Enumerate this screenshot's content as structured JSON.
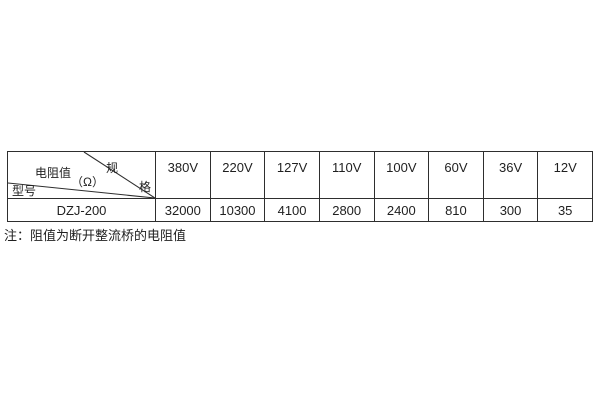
{
  "table": {
    "corner": {
      "spec_top": "规",
      "spec_bottom": "格",
      "resistance_label": "电阻值",
      "resistance_unit": "（Ω）",
      "model_label": "型号"
    },
    "voltage_headers": [
      "380V",
      "220V",
      "127V",
      "110V",
      "100V",
      "60V",
      "36V",
      "12V"
    ],
    "rows": [
      {
        "model": "DZJ-200",
        "values": [
          "32000",
          "10300",
          "4100",
          "2800",
          "2400",
          "810",
          "300",
          "35"
        ]
      }
    ]
  },
  "note": "注：阻值为断开整流桥的电阻值",
  "colors": {
    "background": "#ffffff",
    "border": "#2e2e2e",
    "text": "#1f1f1f"
  }
}
